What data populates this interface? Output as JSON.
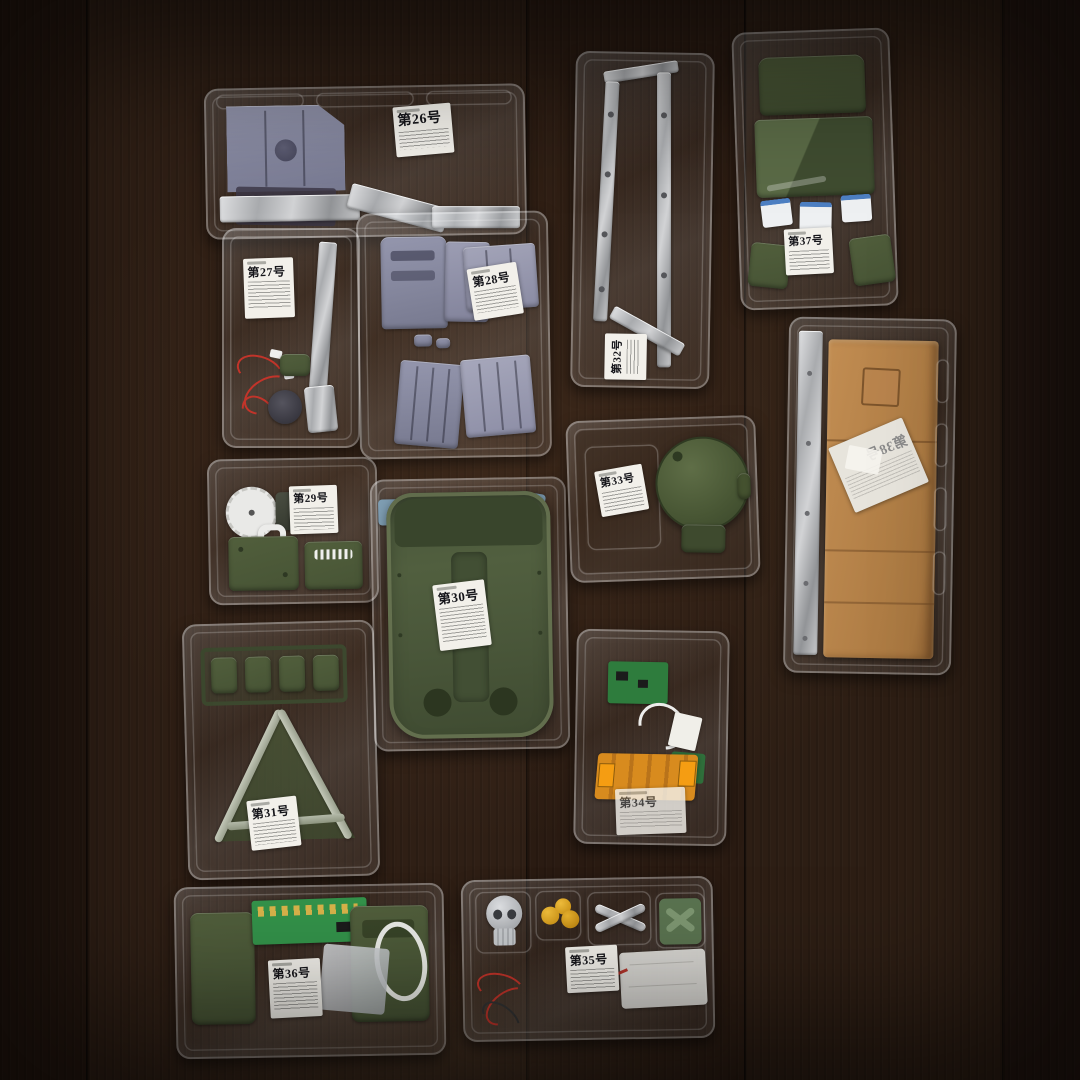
{
  "scene_title": "Model kit subscription blister trays on wooden table",
  "trays": [
    {
      "name": "tray-issue-26",
      "label": "第26号"
    },
    {
      "name": "tray-issue-27",
      "label": "第27号"
    },
    {
      "name": "tray-issue-28",
      "label": "第28号"
    },
    {
      "name": "tray-issue-29",
      "label": "第29号"
    },
    {
      "name": "tray-issue-30",
      "label": "第30号"
    },
    {
      "name": "tray-issue-31",
      "label": "第31号"
    },
    {
      "name": "tray-issue-32",
      "label": "第32号"
    },
    {
      "name": "tray-issue-33",
      "label": "第33号"
    },
    {
      "name": "tray-issue-34",
      "label": "第34号"
    },
    {
      "name": "tray-issue-35",
      "label": "第35号"
    },
    {
      "name": "tray-issue-36",
      "label": "第36号"
    },
    {
      "name": "tray-issue-37",
      "label": "第37号"
    },
    {
      "name": "tray-issue-38",
      "label": "第38号",
      "mirrored": true
    }
  ],
  "palette": {
    "wood": "#2c1d13",
    "olive_part": "#4b5837",
    "lavender_part": "#8e8fa8",
    "silver_part": "#c9cbce",
    "cardboard": "#bc8850",
    "gold_part": "#d79a16",
    "pcb_green": "#33924a",
    "flex_orange": "#d88b1e",
    "wire_red": "#c2342a",
    "label_paper": "#f2f0ea"
  }
}
